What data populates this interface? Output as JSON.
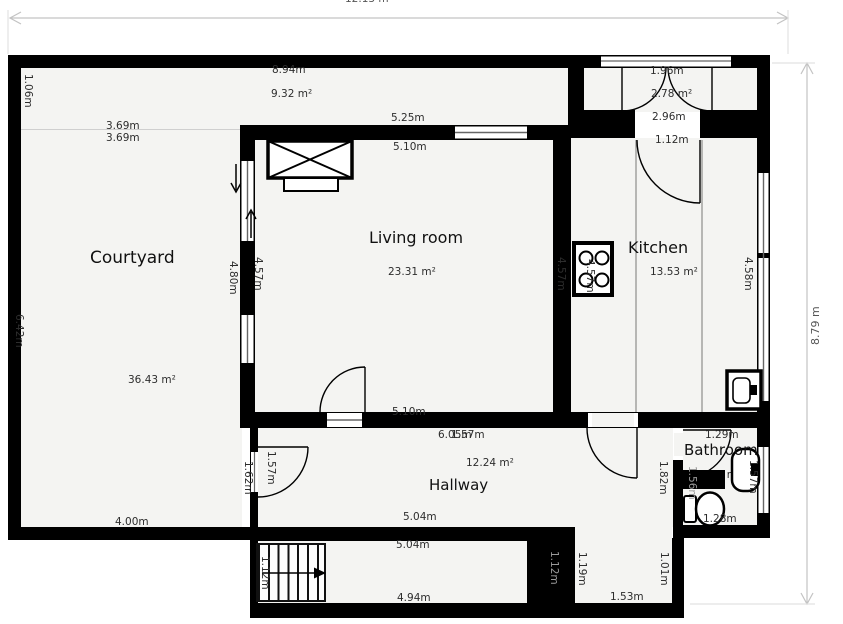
{
  "plan": {
    "overall": {
      "width_label": "12.13 m",
      "height_label": "8.79 m"
    },
    "terrace": {
      "width": "8.94m",
      "area": "9.32 m²",
      "height": "1.06m"
    },
    "courtyard": {
      "name": "Courtyard",
      "area": "36.43 m²",
      "top_width_upper": "3.69m",
      "top_width_lower": "3.69m",
      "left_height": "6.42m",
      "right_height": "4.80m",
      "bottom_width": "4.00m",
      "hall_wall_height": "1.62m"
    },
    "living_room": {
      "name": "Living room",
      "area": "23.31 m²",
      "top_width": "5.25m",
      "top_width_inner": "5.10m",
      "left_height": "4.57m",
      "right_height": "4.57m",
      "bottom_width": "5.10m"
    },
    "entry": {
      "door_width": "1.96m",
      "area": "2.78 m²",
      "width": "2.96m"
    },
    "kitchen": {
      "name": "Kitchen",
      "area": "13.53 m²",
      "door_width": "1.12m",
      "left_height": "4.57m",
      "right_height": "4.58m"
    },
    "hallway": {
      "name": "Hallway",
      "area": "12.24 m²",
      "width": "6.05m",
      "height": "1.57m",
      "door_height": "1.57m",
      "bottom_width": "5.04m"
    },
    "bathroom": {
      "name": "Bathroom",
      "area": "2.01 m²",
      "top_width": "1.29m",
      "bottom_width": "1.28m",
      "left_height": "1.82m",
      "right_height": "1.57m",
      "wall_height": "1.56m"
    },
    "stair_corridor": {
      "top_width": "5.04m",
      "bottom_width": "4.94m",
      "stairs_width": "1.12m",
      "end_wall_width": "1.12m"
    },
    "hall_extension": {
      "left_height": "1.19m",
      "right_height": "1.01m",
      "bottom_width": "1.53m"
    }
  },
  "icons": {
    "stove": "stove-icon",
    "kitchen_sink": "kitchen-sink-icon",
    "toilet": "toilet-icon",
    "washbasin": "washbasin-icon",
    "stairs": "staircase",
    "fireplace": "fireplace-icon",
    "doors": "door-swing-icon",
    "windows": "window-icon"
  },
  "colors": {
    "wall": "#000000",
    "room_fill": "#f4f4f2",
    "background": "#ffffff",
    "dim_line": "#c3c3c3",
    "dim_text": "#555555",
    "label_text": "#2d2d2d",
    "wall_text": "#9a9a9a"
  }
}
